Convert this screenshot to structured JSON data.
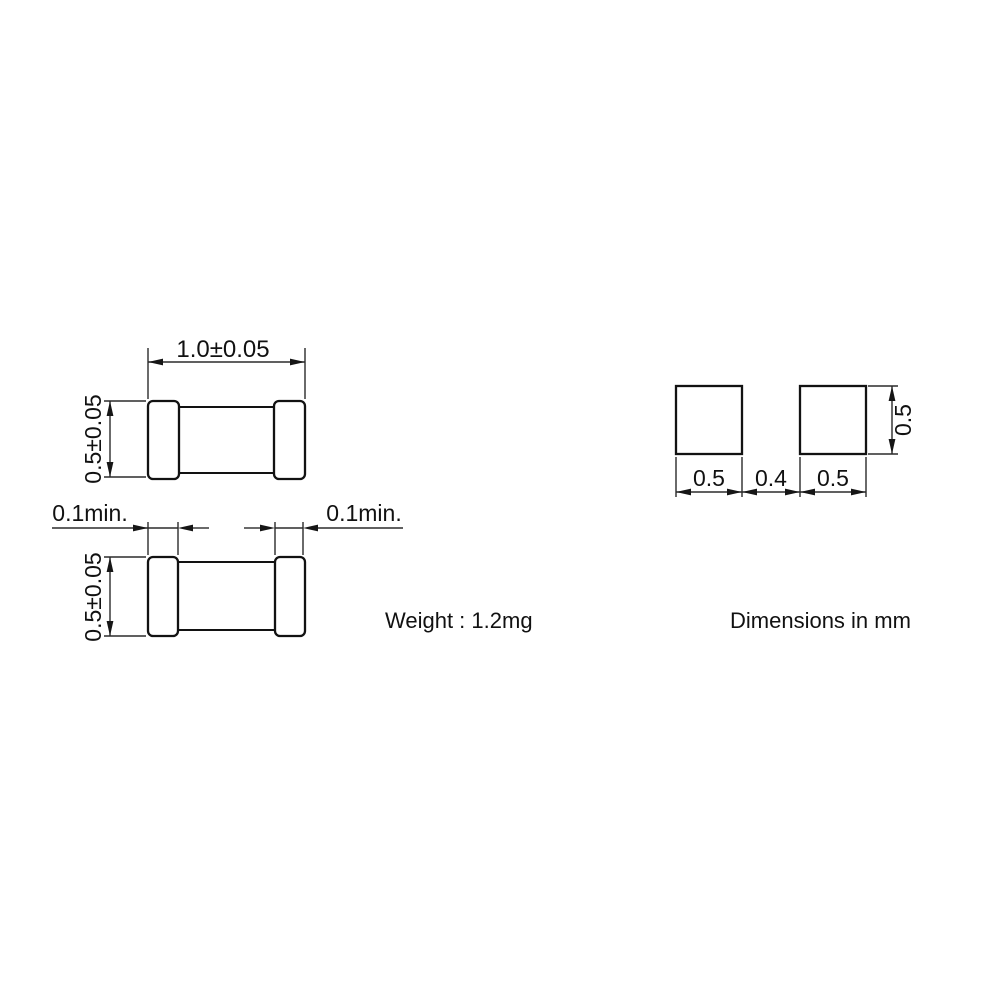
{
  "page": {
    "background": "#ffffff",
    "line_color": "#121212",
    "dim_line_color": "#2b2b2b",
    "text_color": "#111111"
  },
  "top_view": {
    "width_dim": "1.0±0.05",
    "height_dim": "0.5±0.05"
  },
  "side_view": {
    "height_dim": "0.5±0.05",
    "left_termination_dim": "0.1min.",
    "right_termination_dim": "0.1min."
  },
  "land_pattern": {
    "pad_width_left": "0.5",
    "pad_gap": "0.4",
    "pad_width_right": "0.5",
    "pad_height": "0.5"
  },
  "notes": {
    "weight": "Weight : 1.2mg",
    "units": "Dimensions in mm"
  }
}
